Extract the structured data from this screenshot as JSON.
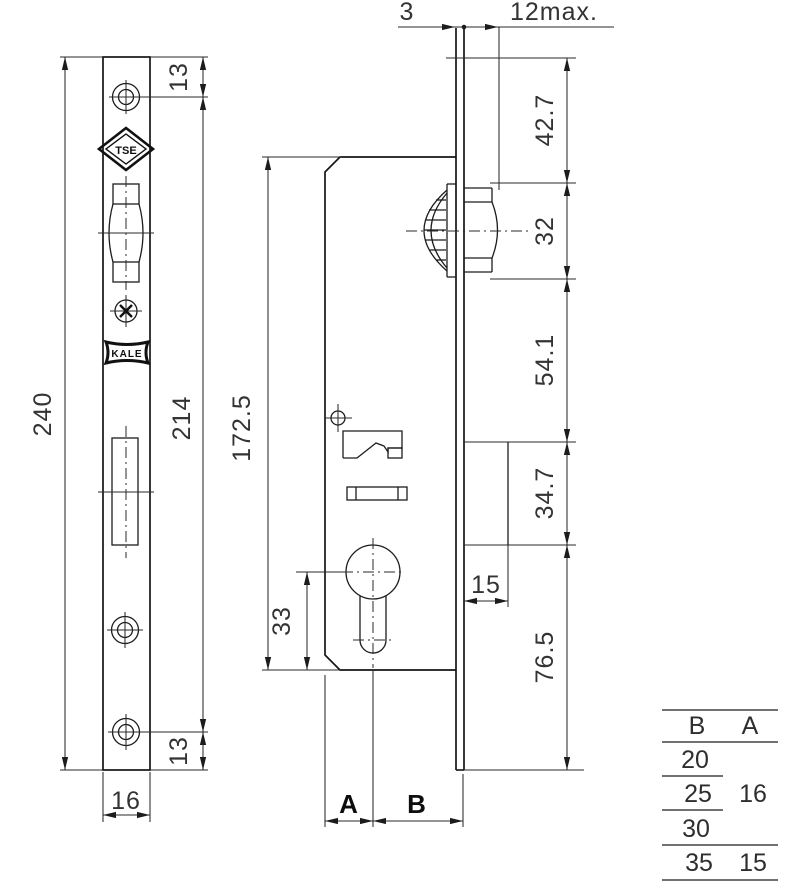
{
  "dimensions": {
    "plate_thickness": "3",
    "knob_protrusion": "12max.",
    "plate_height": "240",
    "screw_span": "214",
    "screw_top_offset": "13",
    "screw_bottom_offset": "13",
    "plate_width": "16",
    "case_height": "172.5",
    "cylinder_to_bottom": "33",
    "dim_a_label": "A",
    "dim_b_label": "B",
    "top_to_knob": "42.7",
    "knob_height": "32",
    "knob_to_box": "54.1",
    "box_height": "34.7",
    "box_width": "15",
    "box_to_bottom": "76.5"
  },
  "logos": {
    "tse": "TSE",
    "kale": "KALE"
  },
  "table": {
    "header_b": "B",
    "header_a": "A",
    "rows": [
      {
        "b": "20",
        "a": ""
      },
      {
        "b": "25",
        "a": "16"
      },
      {
        "b": "30",
        "a": ""
      },
      {
        "b": "35",
        "a": "15"
      }
    ]
  }
}
